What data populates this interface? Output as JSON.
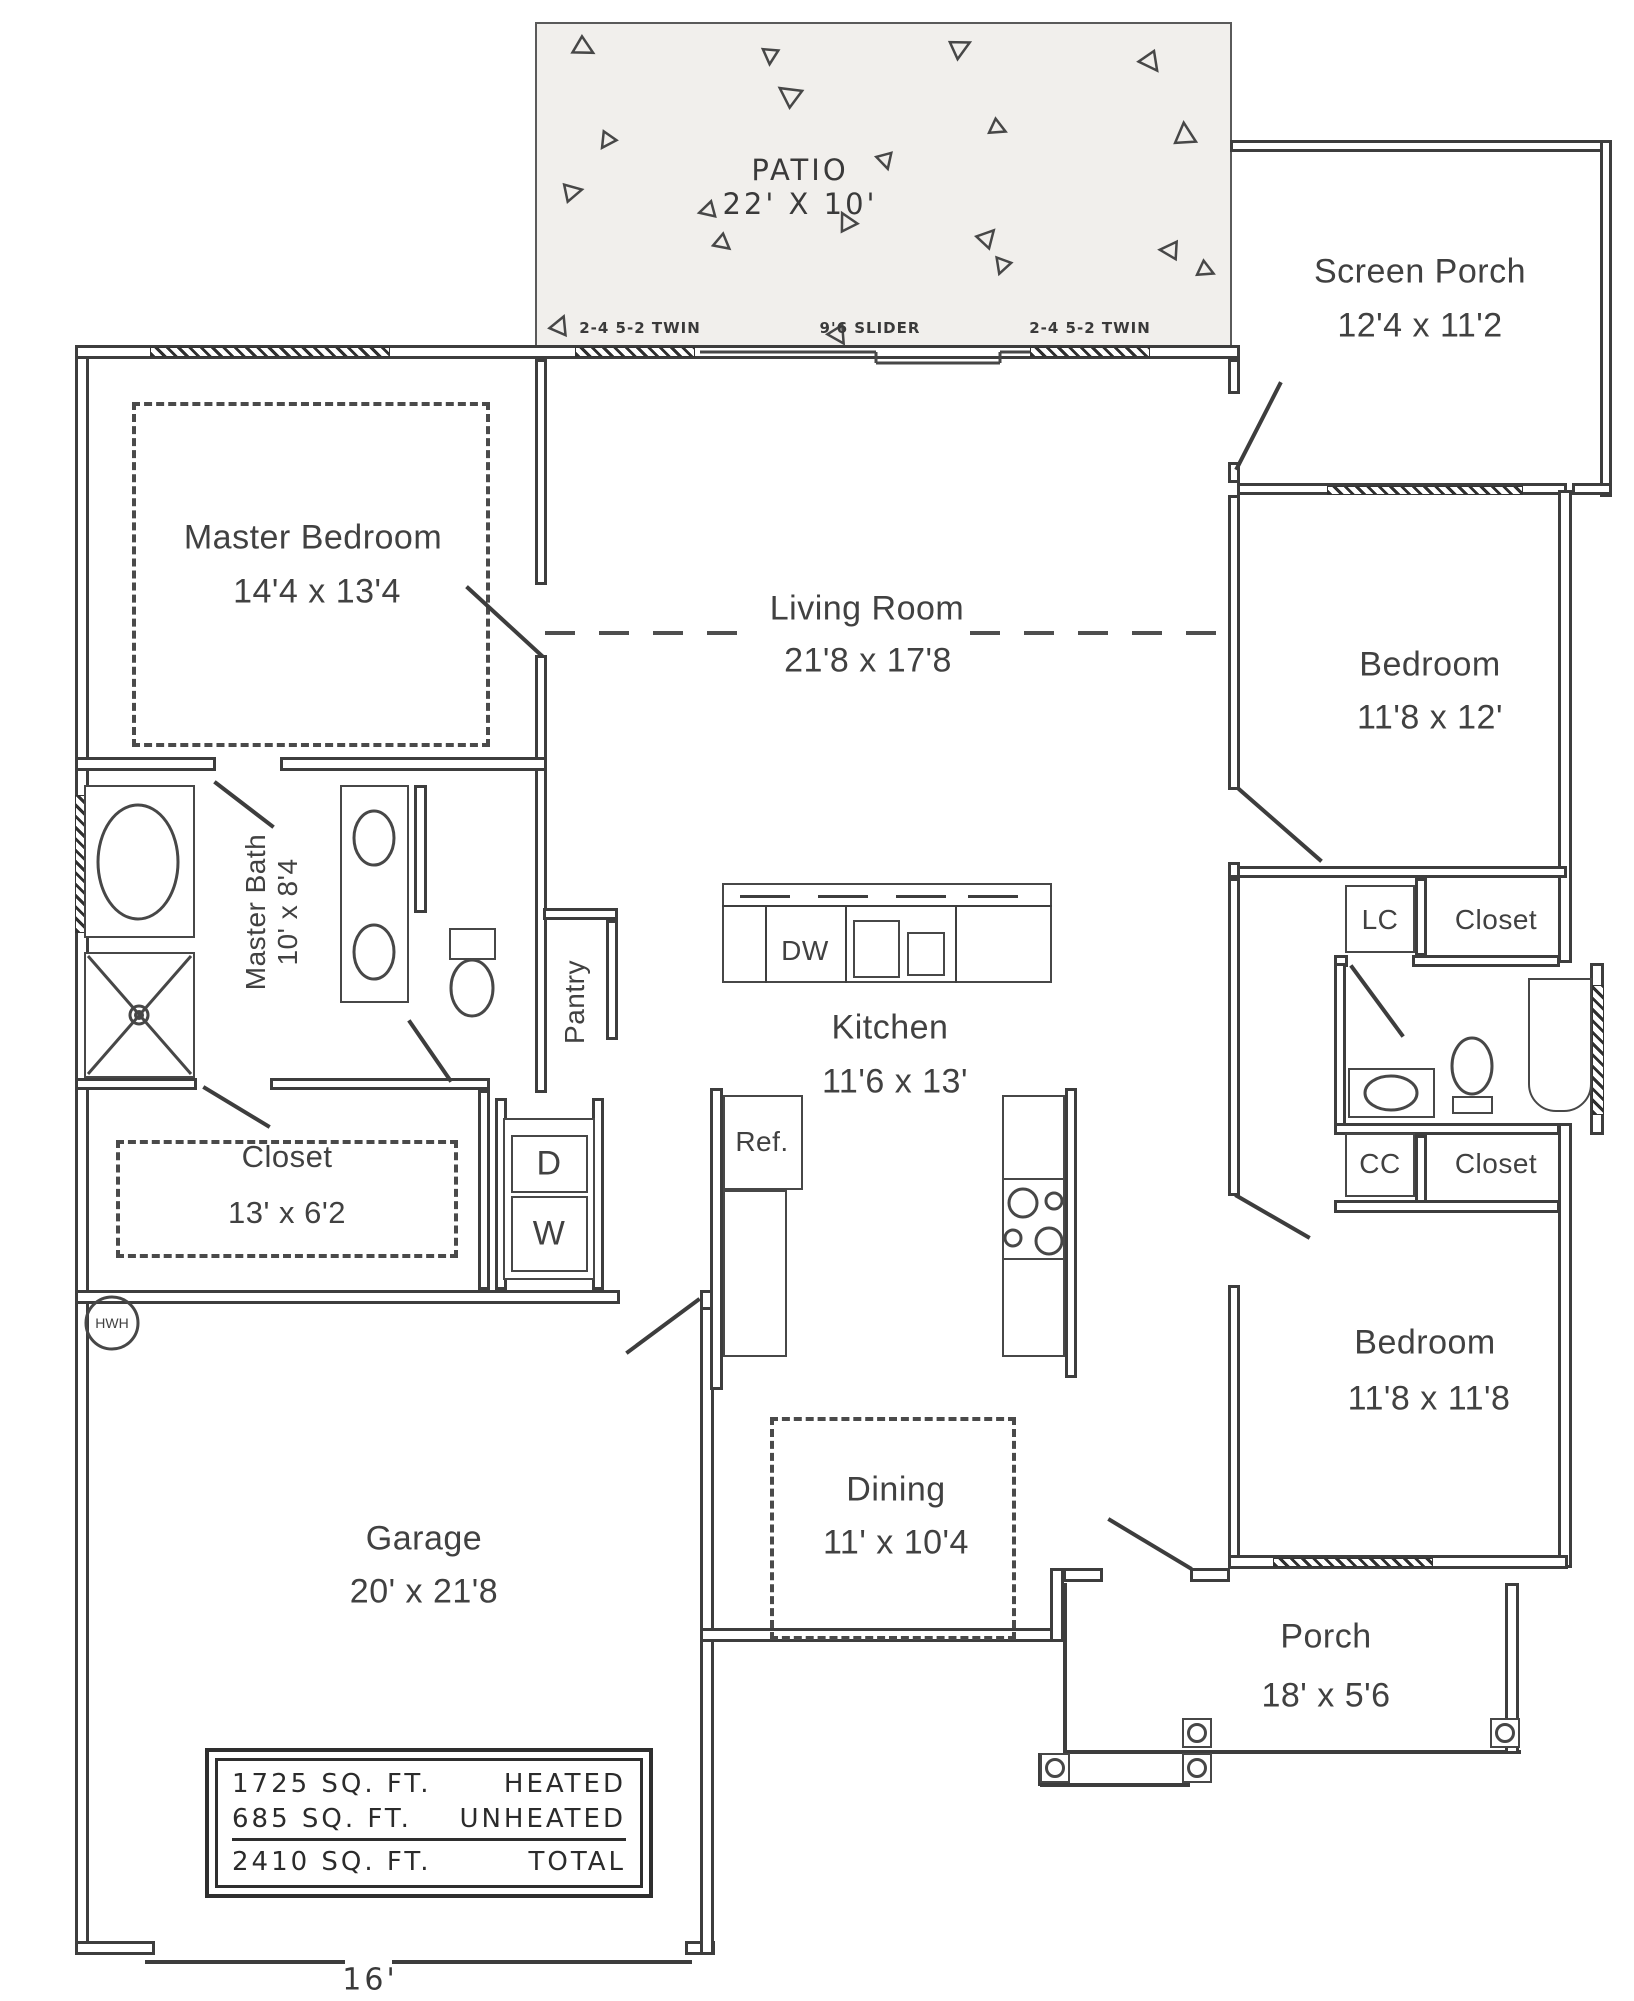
{
  "plan": {
    "rooms": {
      "patio": {
        "name": "PATIO",
        "dims": "22' X 10'"
      },
      "screen_porch": {
        "name": "Screen Porch",
        "dims": "12'4 x 11'2"
      },
      "master_bedroom": {
        "name": "Master Bedroom",
        "dims": "14'4 x 13'4"
      },
      "living_room": {
        "name": "Living Room",
        "dims": "21'8 x 17'8"
      },
      "bedroom_upper": {
        "name": "Bedroom",
        "dims": "11'8 x 12'"
      },
      "master_bath": {
        "name": "Master Bath",
        "dims": "10' x 8'4"
      },
      "pantry": {
        "name": "Pantry"
      },
      "kitchen": {
        "name": "Kitchen",
        "dims": "11'6 x 13'"
      },
      "master_closet": {
        "name": "Closet",
        "dims": "13' x 6'2"
      },
      "bedroom_lower": {
        "name": "Bedroom",
        "dims": "11'8 x 11'8"
      },
      "dining": {
        "name": "Dining",
        "dims": "11' x 10'4"
      },
      "garage": {
        "name": "Garage",
        "dims": "20' x 21'8"
      },
      "porch": {
        "name": "Porch",
        "dims": "18' x 5'6"
      }
    },
    "fixtures": {
      "dishwasher": "DW",
      "refrigerator": "Ref.",
      "dryer": "D",
      "washer": "W",
      "water_heater": "HWH",
      "linen_closet": "LC",
      "coat_closet": "CC",
      "closet_upper": "Closet",
      "closet_lower": "Closet"
    },
    "annotations": {
      "window_left": "2-4 5-2 TWIN",
      "slider": "9'6 SLIDER",
      "window_right": "2-4 5-2 TWIN",
      "garage_door_width": "16'"
    },
    "area_table": {
      "rows": [
        {
          "area": "1725 SQ. FT.",
          "label": "HEATED"
        },
        {
          "area": "685 SQ. FT.",
          "label": "UNHEATED"
        },
        {
          "area": "2410 SQ. FT.",
          "label": "TOTAL"
        }
      ]
    }
  }
}
